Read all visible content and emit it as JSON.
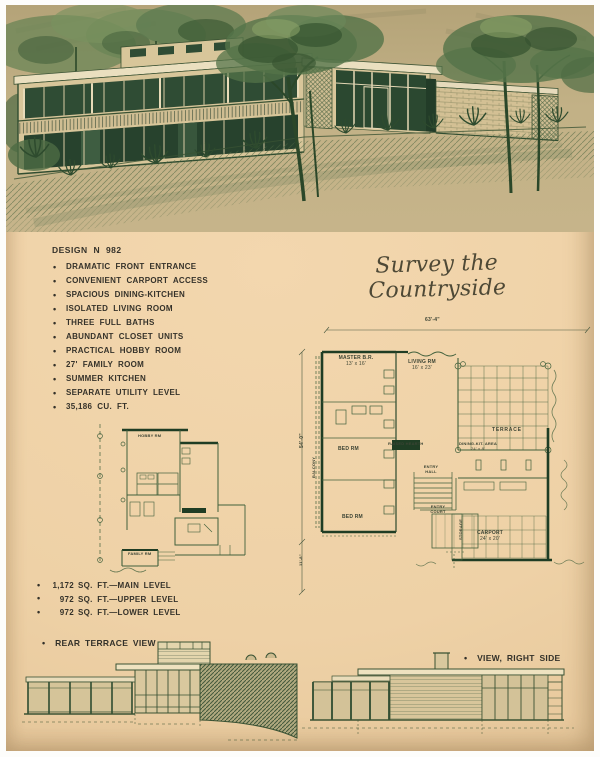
{
  "page": {
    "script_title": "Survey the Countryside"
  },
  "design": {
    "heading": "DESIGN N 982",
    "features": [
      "DRAMATIC FRONT ENTRANCE",
      "CONVENIENT CARPORT ACCESS",
      "SPACIOUS DINING-KITCHEN",
      "ISOLATED LIVING ROOM",
      "THREE FULL BATHS",
      "ABUNDANT CLOSET UNITS",
      "PRACTICAL HOBBY ROOM",
      "27' FAMILY ROOM",
      "SUMMER KITCHEN",
      "SEPARATE UTILITY LEVEL",
      "35,186 CU. FT."
    ]
  },
  "areas": [
    {
      "num": "1,172",
      "label": "SQ. FT.—MAIN LEVEL"
    },
    {
      "num": "972",
      "label": "SQ. FT.—UPPER LEVEL"
    },
    {
      "num": "972",
      "label": "SQ. FT.—LOWER LEVEL"
    }
  ],
  "views": {
    "rear": "REAR TERRACE VIEW",
    "right": "VIEW, RIGHT SIDE"
  },
  "plan_main": {
    "dims": {
      "width": "63'-4\"",
      "height": "54'-0\"",
      "lower": "11'-8\""
    },
    "labels": {
      "master": "MASTER B.R.",
      "master_size": "13' x 16'",
      "living": "LIVING RM",
      "living_size": "16' x 23'",
      "terrace": "TERRACE",
      "dining": "DINING-KIT. AREA",
      "dining_size": "24' x 8'",
      "hearth": "RAISED HEARTH",
      "bed1": "BED RM",
      "bed2": "BED RM",
      "entry_hall": "ENTRY HALL",
      "entry_court": "ENTRY COURT",
      "carport": "CARPORT",
      "carport_size": "24' x 20'",
      "storage": "STORAGE",
      "balcony": "BALCONY"
    }
  },
  "plan_lower": {
    "labels": {
      "hobby": "HOBBY RM",
      "family": "FAMILY RM"
    }
  },
  "colors": {
    "paper": "#f0d2a7",
    "ink": "#35322a",
    "plan_line": "#3f5a38",
    "illustration_bg": "#bfae83"
  }
}
